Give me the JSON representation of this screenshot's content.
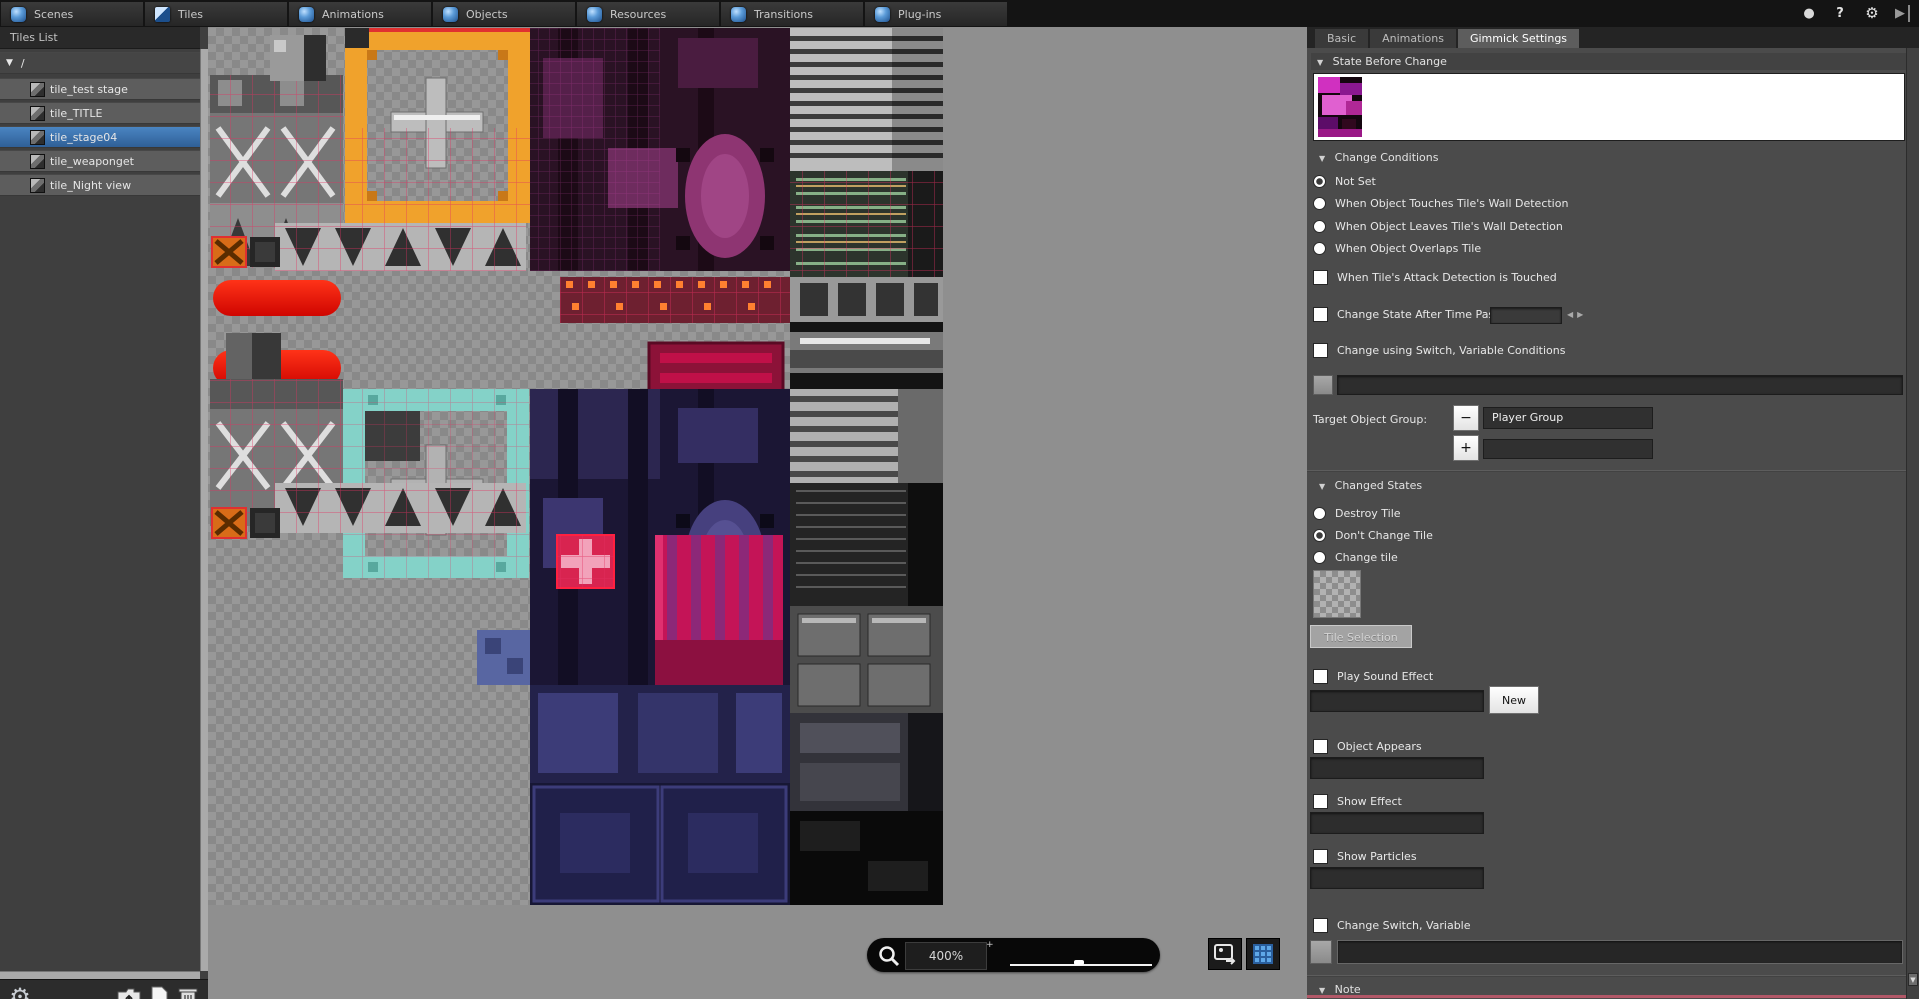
{
  "titlebar": {
    "tabs": [
      {
        "label": "Scenes"
      },
      {
        "label": "Tiles"
      },
      {
        "label": "Animations"
      },
      {
        "label": "Objects"
      },
      {
        "label": "Resources"
      },
      {
        "label": "Transitions"
      },
      {
        "label": "Plug-ins"
      }
    ],
    "window_icons": {
      "lamp": "●",
      "help": "?",
      "gear": "⚙",
      "play": "▶"
    }
  },
  "sidebar": {
    "title": "Tiles List",
    "root_label": "/",
    "items": [
      {
        "label": "tile_test stage",
        "selected": false
      },
      {
        "label": "tile_TITLE",
        "selected": false
      },
      {
        "label": "tile_stage04",
        "selected": true
      },
      {
        "label": "tile_weaponget",
        "selected": false
      },
      {
        "label": "tile_Night view",
        "selected": false
      }
    ]
  },
  "canvas": {
    "zoom_value": "400%",
    "zoom_plus_glyph": "+"
  },
  "glyphs": {
    "collapse": "▼",
    "spin_left": "◀",
    "spin_right": "▶",
    "minus": "−",
    "plus": "+",
    "scroll_down": "▼"
  },
  "panel": {
    "tabs": [
      {
        "label": "Basic",
        "selected": false
      },
      {
        "label": "Animations",
        "selected": false
      },
      {
        "label": "Gimmick Settings",
        "selected": true
      }
    ],
    "state_before_change": {
      "title": "State Before Change"
    },
    "change_conditions": {
      "title": "Change Conditions",
      "radios": [
        {
          "label": "Not Set",
          "selected": true
        },
        {
          "label": "When Object Touches Tile's Wall Detection",
          "selected": false
        },
        {
          "label": "When Object Leaves Tile's Wall Detection",
          "selected": false
        },
        {
          "label": "When Object Overlaps Tile",
          "selected": false
        }
      ],
      "attack_checkbox": "When Tile's Attack Detection is Touched",
      "time_checkbox": "Change State After Time Passes",
      "switch_checkbox": "Change using Switch, Variable Conditions"
    },
    "target_object_group": {
      "label": "Target Object Group:",
      "selected_group": "Player Group"
    },
    "changed_states": {
      "title": "Changed States",
      "radios": [
        {
          "label": "Destroy Tile",
          "selected": false
        },
        {
          "label": "Don't Change Tile",
          "selected": true
        },
        {
          "label": "Change tile",
          "selected": false
        }
      ],
      "tile_selection_button": "Tile Selection"
    },
    "effects": {
      "play_sound": "Play Sound Effect",
      "new_button": "New",
      "object_appears": "Object Appears",
      "show_effect": "Show Effect",
      "show_particles": "Show Particles",
      "change_switch": "Change Switch, Variable"
    },
    "note": {
      "title": "Note"
    }
  }
}
